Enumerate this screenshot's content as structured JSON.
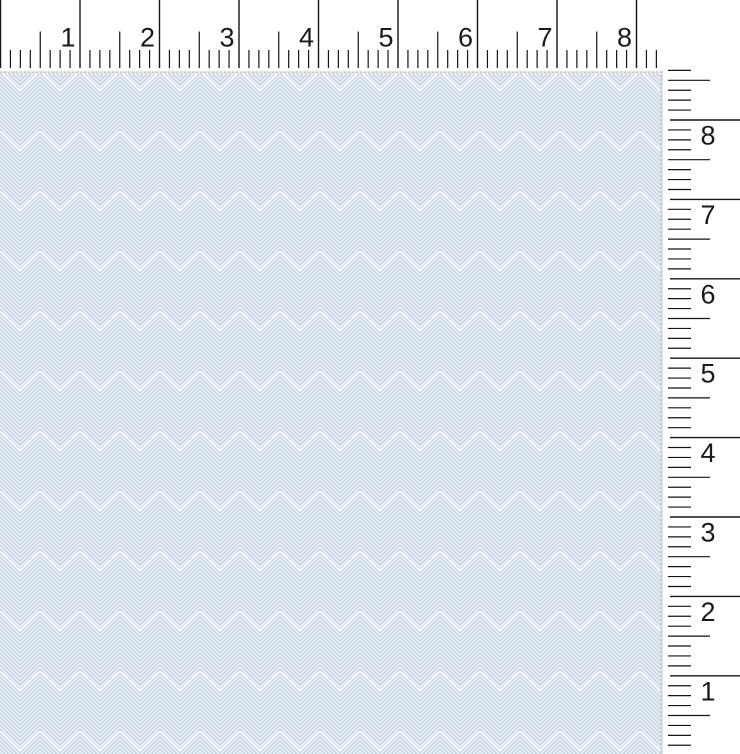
{
  "app": {
    "name": "Fabric swatch viewer",
    "description": "Light blue herringbone fabric swatch shown against horizontal and vertical inch rulers"
  },
  "top_ruler": {
    "unit": "inches",
    "labels": [
      "1",
      "2",
      "3",
      "4",
      "5",
      "6",
      "7",
      "8"
    ]
  },
  "right_ruler": {
    "unit": "inches",
    "labels": [
      "8",
      "7",
      "6",
      "5",
      "4",
      "3",
      "2",
      "1"
    ]
  },
  "fabric": {
    "pattern": "herringbone-weave",
    "colors": {
      "base": "#d8e1ee",
      "stripe_light": "#ffffff",
      "stripe_dark": "#b5c5e0",
      "edge_dot_tan": "#cfc8b8",
      "edge_dot_blue": "#dde6f1"
    }
  },
  "ruler_style": {
    "background": "#ffffff",
    "tick_color": "#141414",
    "label_color": "#1a1a1a"
  }
}
